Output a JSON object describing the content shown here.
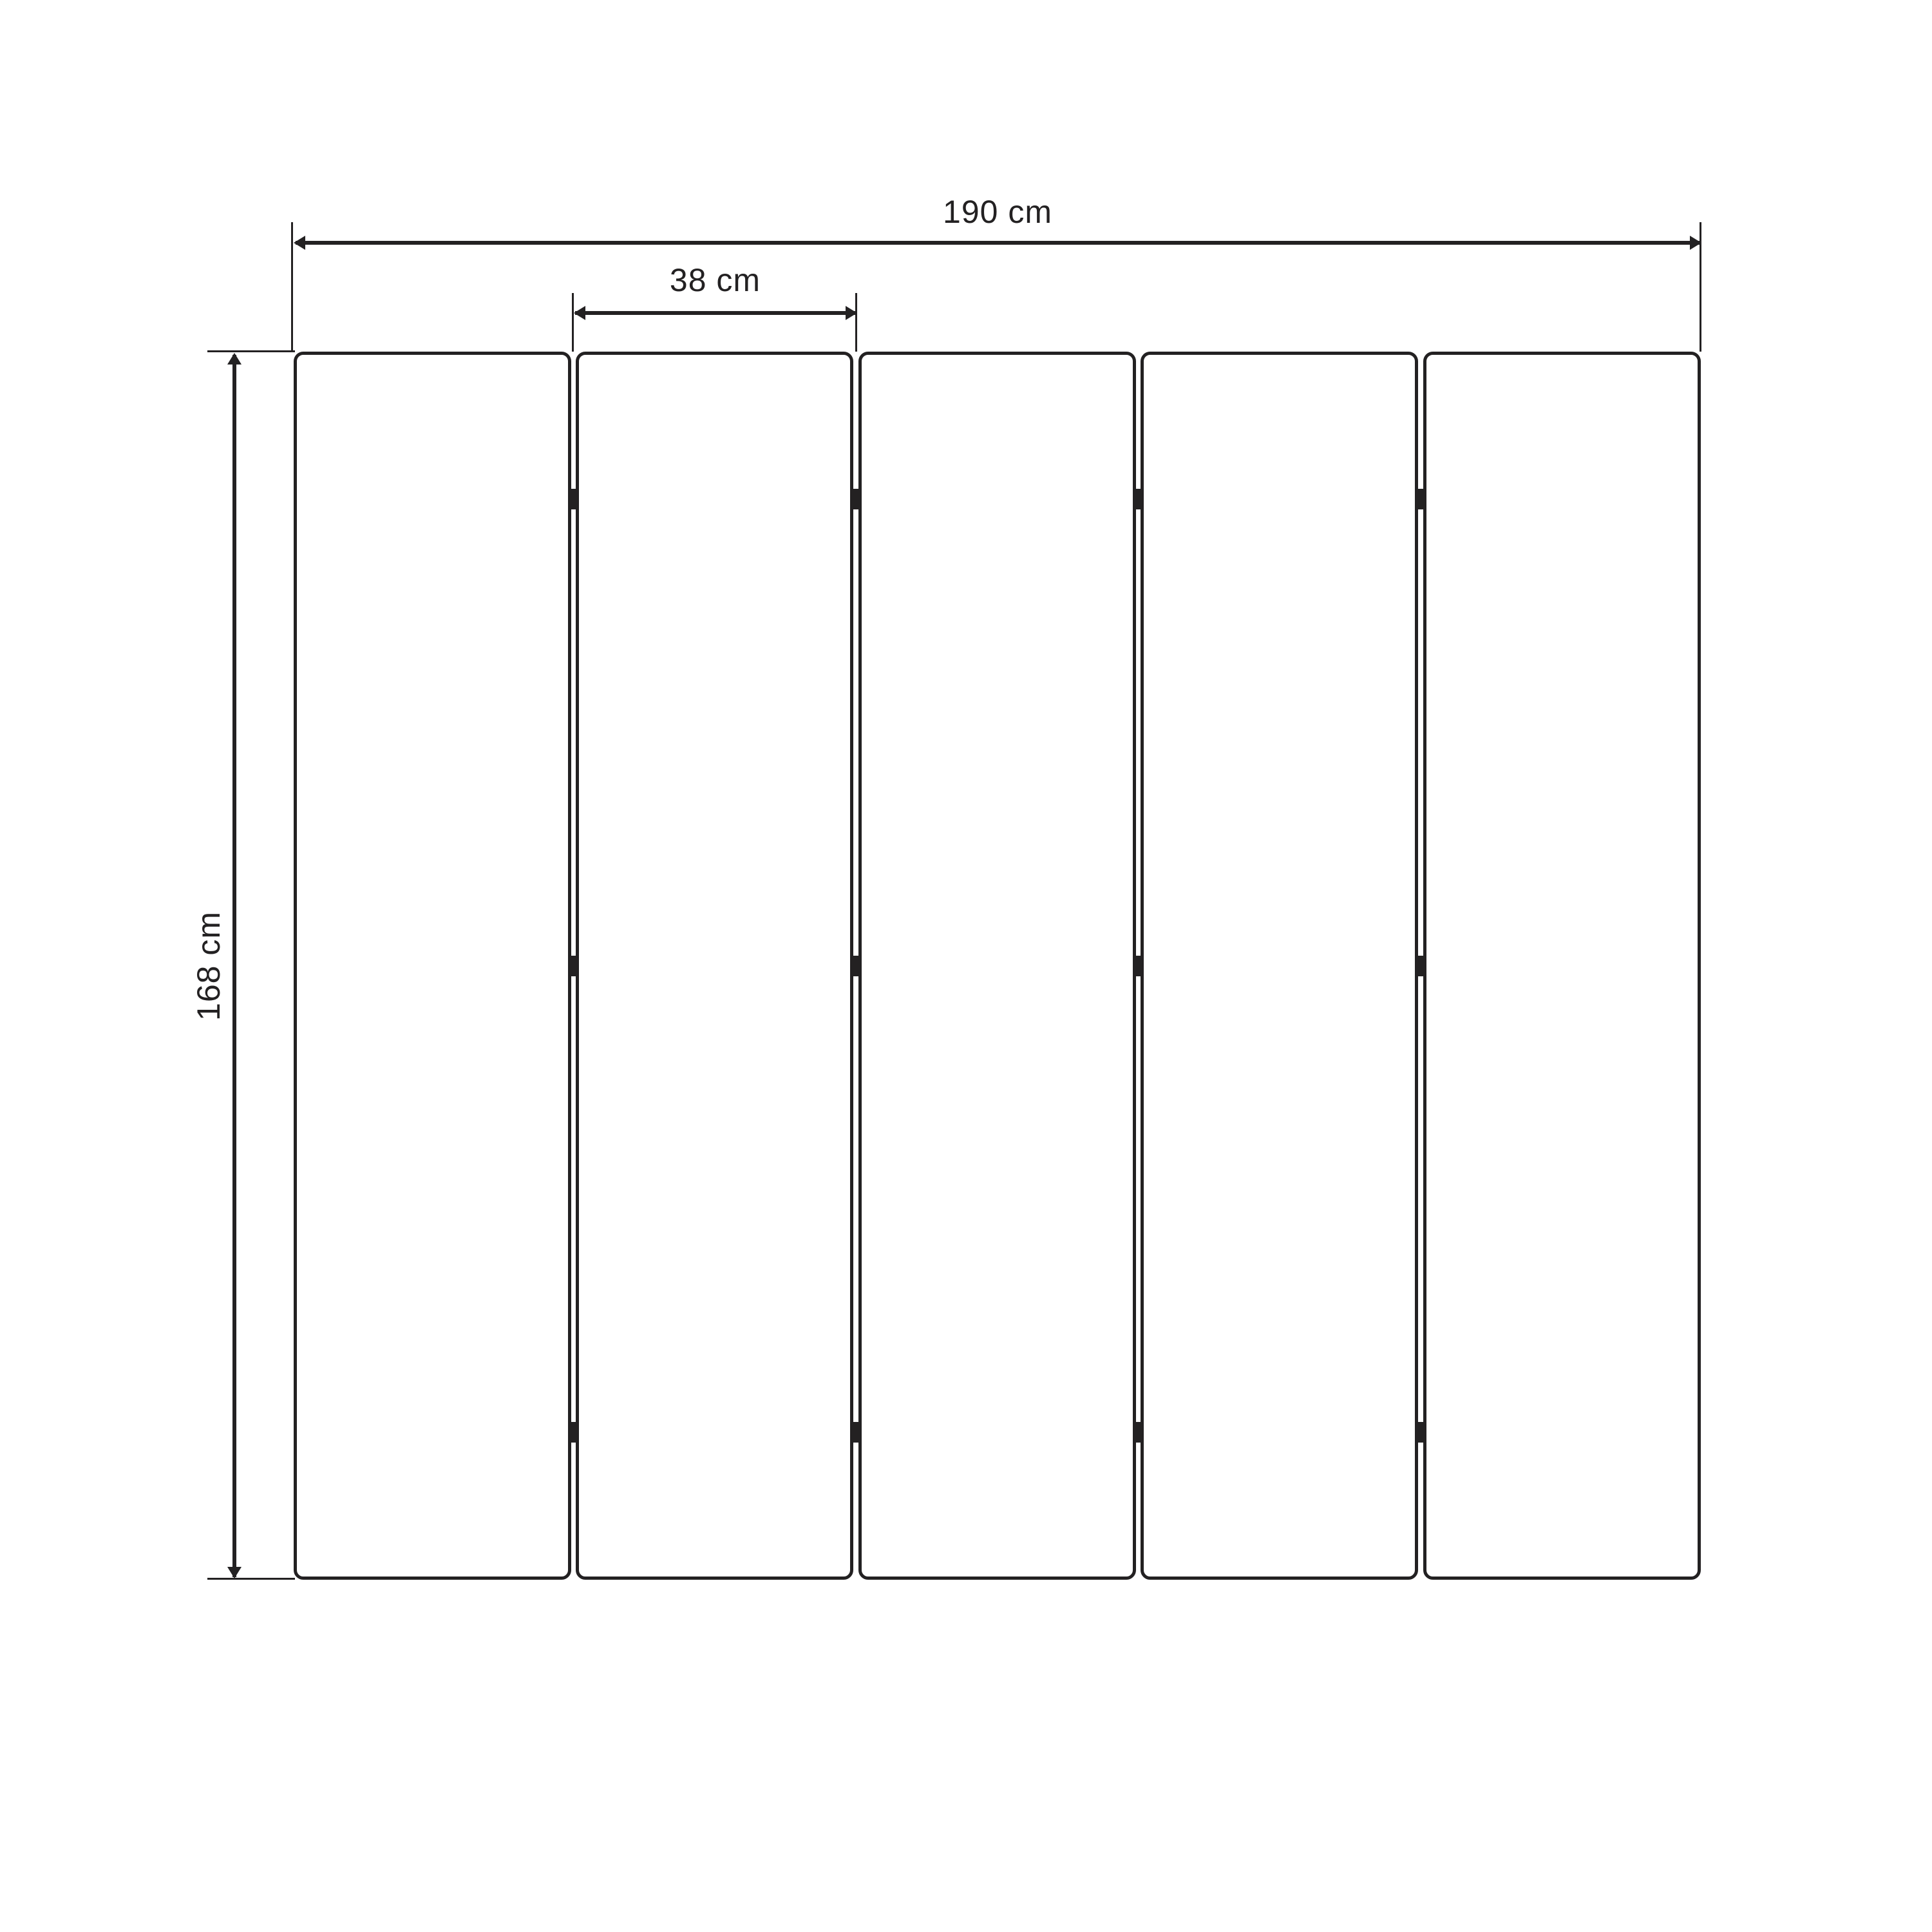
{
  "diagram": {
    "subject": "five-panel-room-divider-dimensions",
    "panel_count": 5,
    "hinges_per_seam": 3,
    "dimensions": {
      "total_width_label": "190 cm",
      "panel_width_label": "38 cm",
      "height_label": "168 cm"
    },
    "colors": {
      "ink": "#232122",
      "background": "#ffffff"
    }
  }
}
